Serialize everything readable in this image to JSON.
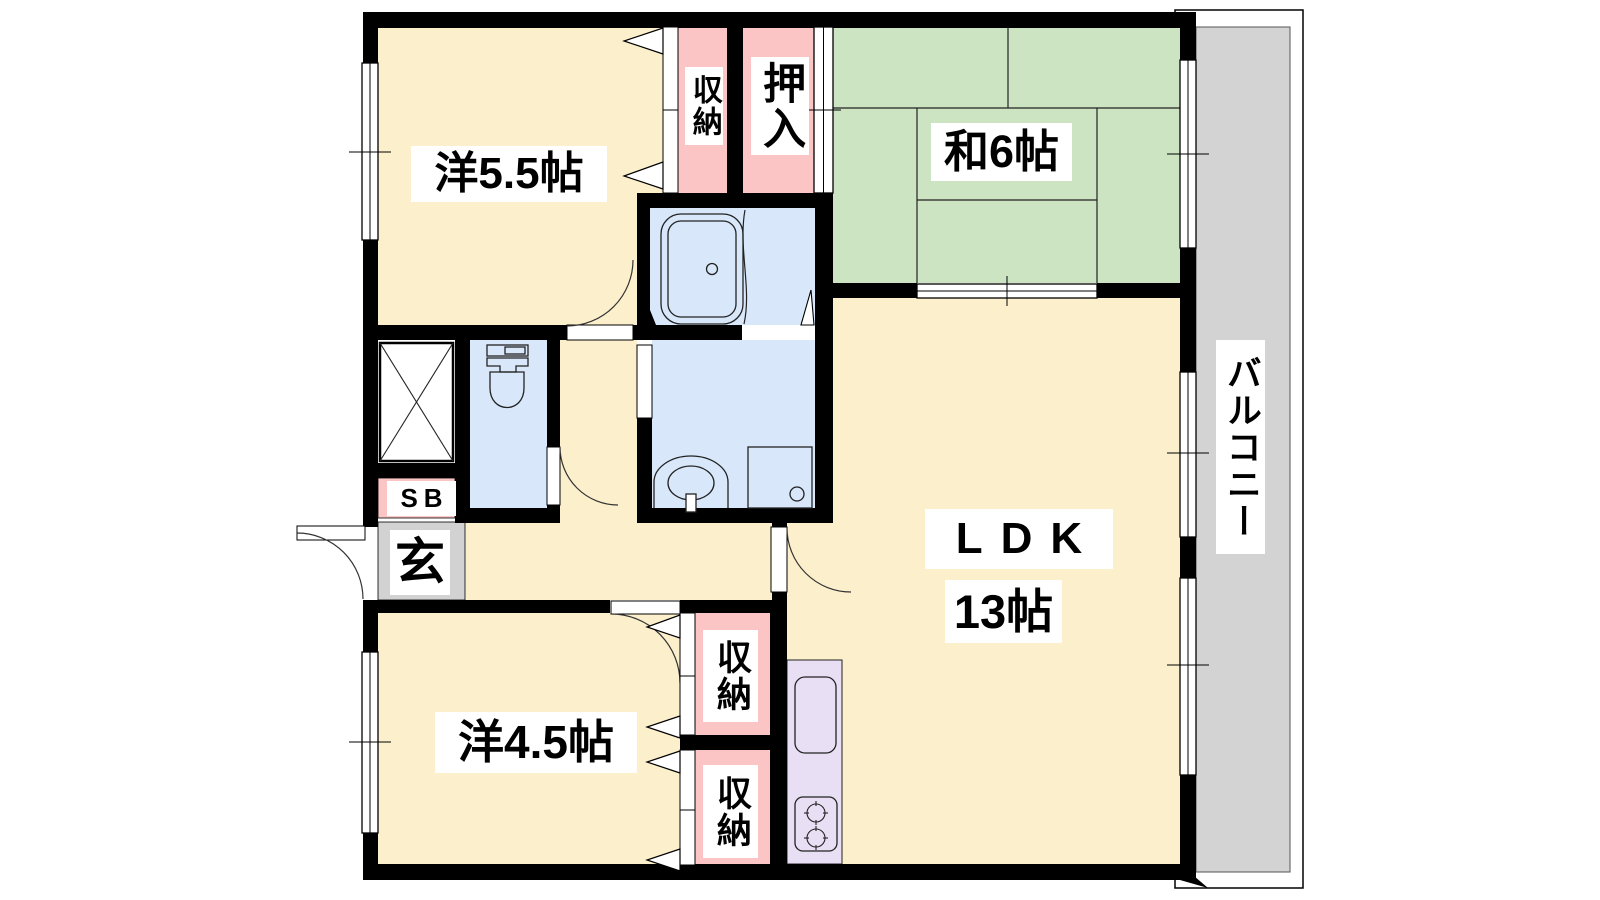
{
  "rooms": {
    "western_5_5": {
      "label": "洋5.5帖"
    },
    "closet_top": {
      "label": "収納"
    },
    "oshiire": {
      "label": "押入"
    },
    "japanese_6": {
      "label": "和6帖"
    },
    "balcony": {
      "label": "バルコニー"
    },
    "ldk": {
      "label": "LDK",
      "size": "13帖"
    },
    "western_4_5": {
      "label": "洋4.5帖"
    },
    "closet_lower_top": {
      "label": "収納"
    },
    "closet_lower_bottom": {
      "label": "収納"
    },
    "shoe_box": {
      "label": "SB"
    },
    "entrance": {
      "label": "玄"
    }
  },
  "colors": {
    "floor": "#FCEFCC",
    "tatami": "#CDE4C3",
    "closet": "#FBC5C6",
    "wet_area": "#D8E8FA",
    "kitchen": "#E8DFF4",
    "balcony": "#D3D3D3",
    "entrance": "#D2D2D2",
    "wall": "#000000"
  }
}
